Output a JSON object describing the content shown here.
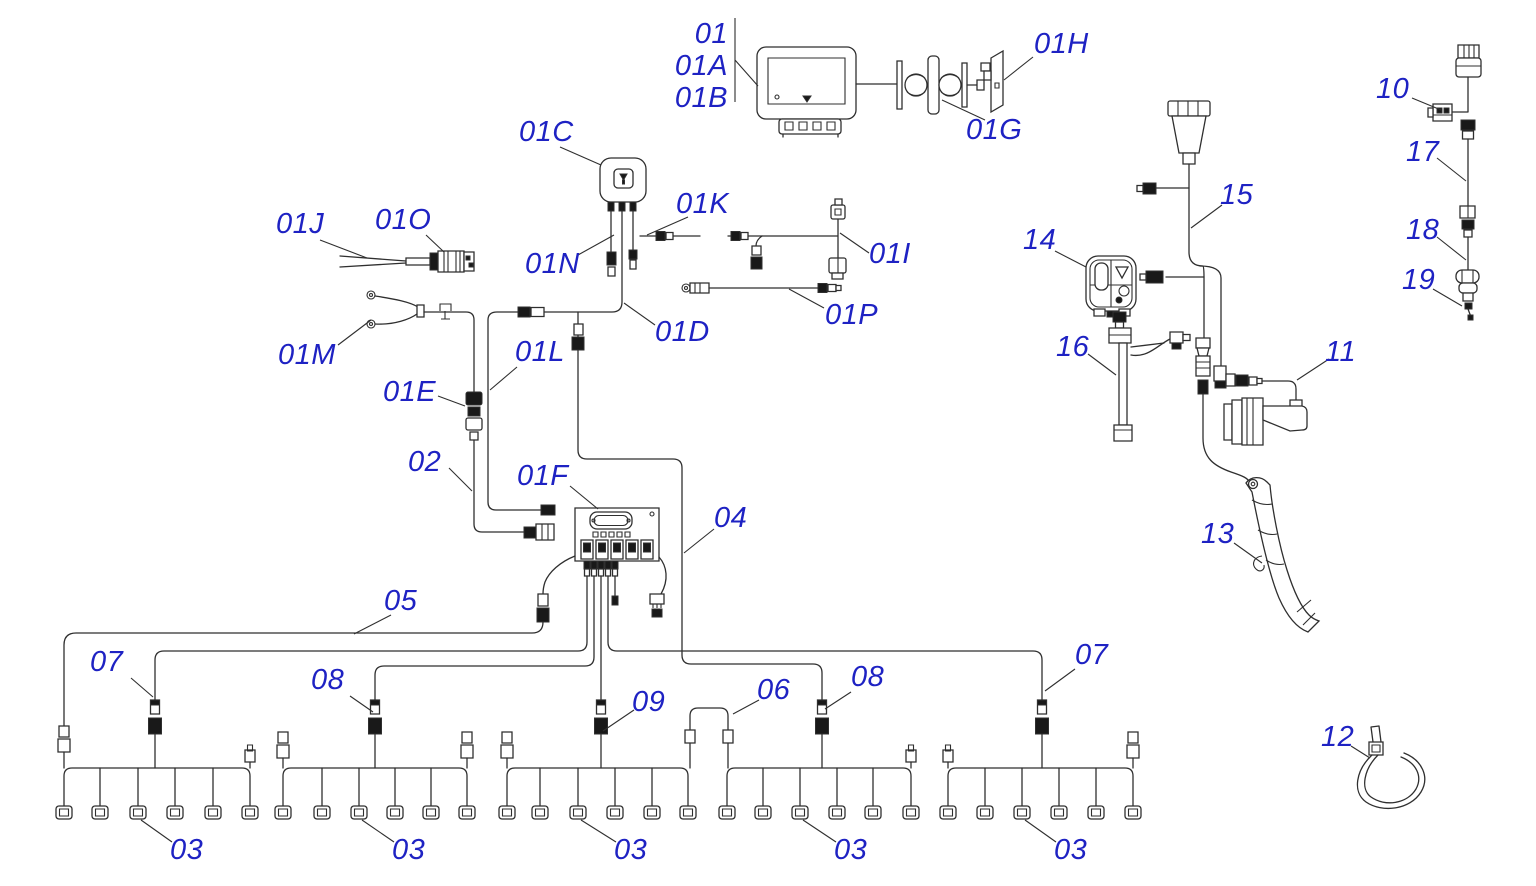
{
  "colors": {
    "callout": "#1e22c3",
    "line": "#2f2f2f",
    "background": "#ffffff"
  },
  "callouts": [
    {
      "id": "01",
      "text": "01"
    },
    {
      "id": "01A",
      "text": "01A"
    },
    {
      "id": "01B",
      "text": "01B"
    },
    {
      "id": "01H",
      "text": "01H"
    },
    {
      "id": "01G",
      "text": "01G"
    },
    {
      "id": "01C",
      "text": "01C"
    },
    {
      "id": "01K",
      "text": "01K"
    },
    {
      "id": "01N",
      "text": "01N"
    },
    {
      "id": "01J",
      "text": "01J"
    },
    {
      "id": "01O",
      "text": "01O"
    },
    {
      "id": "01I",
      "text": "01I"
    },
    {
      "id": "01D",
      "text": "01D"
    },
    {
      "id": "01P",
      "text": "01P"
    },
    {
      "id": "01M",
      "text": "01M"
    },
    {
      "id": "01E",
      "text": "01E"
    },
    {
      "id": "01L",
      "text": "01L"
    },
    {
      "id": "02",
      "text": "02"
    },
    {
      "id": "01F",
      "text": "01F"
    },
    {
      "id": "04",
      "text": "04"
    },
    {
      "id": "05",
      "text": "05"
    },
    {
      "id": "07-left",
      "text": "07"
    },
    {
      "id": "08-left",
      "text": "08"
    },
    {
      "id": "09",
      "text": "09"
    },
    {
      "id": "06",
      "text": "06"
    },
    {
      "id": "08-right",
      "text": "08"
    },
    {
      "id": "07-right",
      "text": "07"
    },
    {
      "id": "03-group1",
      "text": "03"
    },
    {
      "id": "03-group2",
      "text": "03"
    },
    {
      "id": "03-group3",
      "text": "03"
    },
    {
      "id": "03-group4",
      "text": "03"
    },
    {
      "id": "03-group5",
      "text": "03"
    },
    {
      "id": "10",
      "text": "10"
    },
    {
      "id": "17",
      "text": "17"
    },
    {
      "id": "18",
      "text": "18"
    },
    {
      "id": "19",
      "text": "19"
    },
    {
      "id": "15",
      "text": "15"
    },
    {
      "id": "14",
      "text": "14"
    },
    {
      "id": "16",
      "text": "16"
    },
    {
      "id": "11",
      "text": "11"
    },
    {
      "id": "13",
      "text": "13"
    },
    {
      "id": "12",
      "text": "12"
    }
  ]
}
